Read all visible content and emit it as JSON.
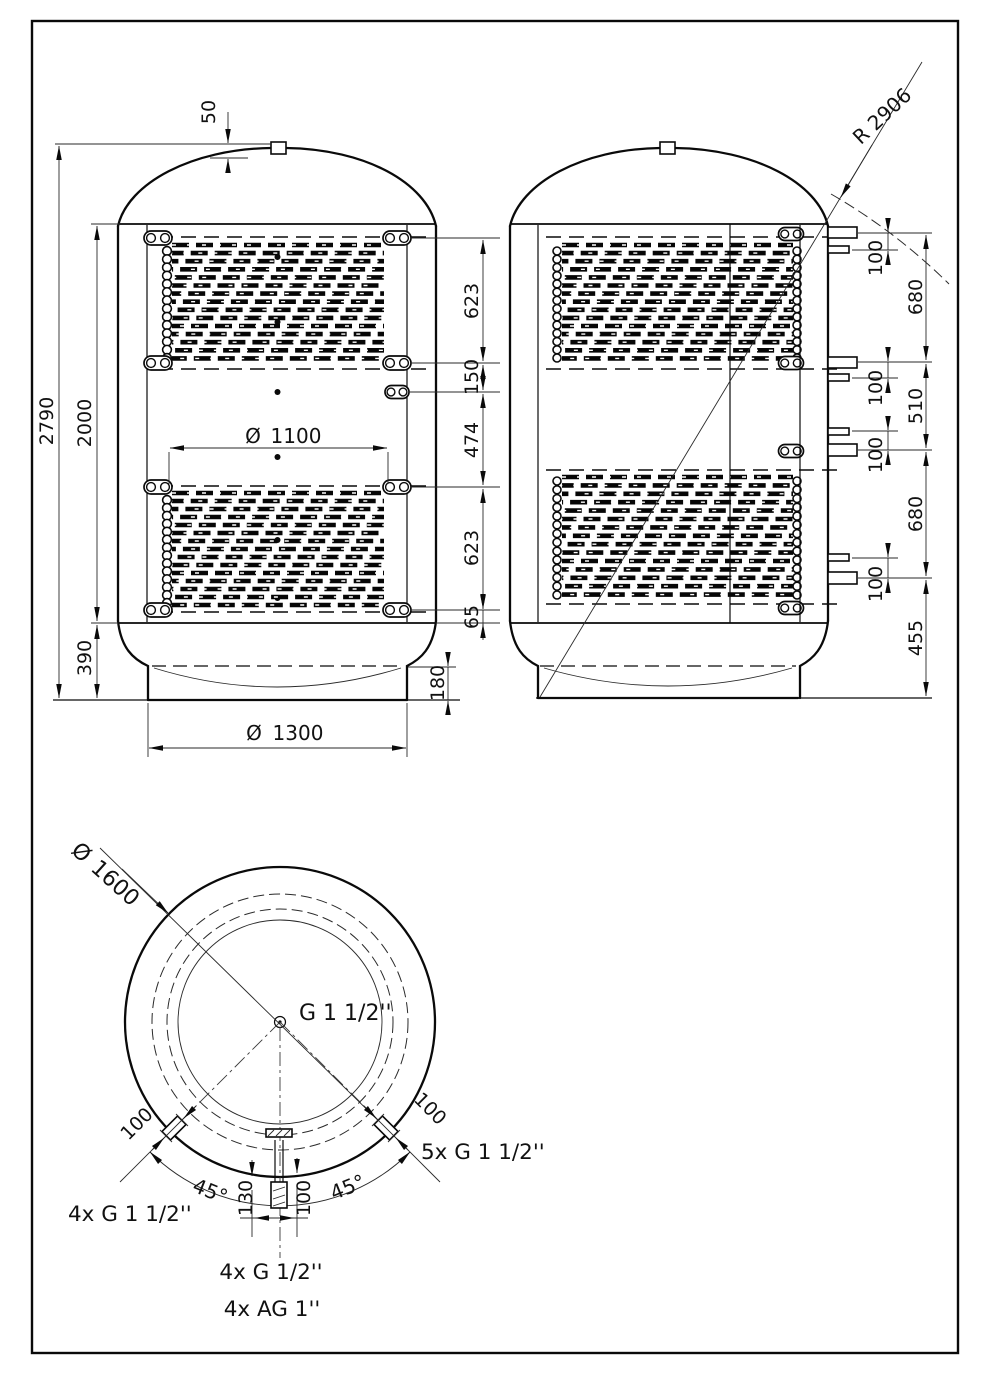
{
  "front_view": {
    "flange_height": "50",
    "total_height": "2790",
    "shell_height": "2000",
    "base_height": "390",
    "coil_upper": "623",
    "gap_150": "150",
    "gap_474": "474",
    "coil_lower": "623",
    "offset_65": "65",
    "skirt_height": "180",
    "dia_symbol": "Ø",
    "coil_diameter": "1100",
    "base_diameter": "1300"
  },
  "side_view": {
    "crown_radius": "R 2906",
    "nozzle_gaps": [
      "100",
      "100",
      "100",
      "100"
    ],
    "span_upper": "680",
    "span_middle": "510",
    "span_lower": "680",
    "span_base": "455"
  },
  "bottom_view": {
    "dia_symbol": "Ø",
    "outer_diameter": "1600",
    "center_connection": "G 1 1/2''",
    "left_angle": "45°",
    "right_angle": "45°",
    "offset_130": "130",
    "offset_100": "100",
    "nozzle_len_left": "100",
    "nozzle_len_right": "100",
    "label_left": "4x G 1 1/2''",
    "label_right": "5x G 1 1/2''",
    "label_bottom_1": "4x G 1/2''",
    "label_bottom_2": "4x AG 1''"
  }
}
